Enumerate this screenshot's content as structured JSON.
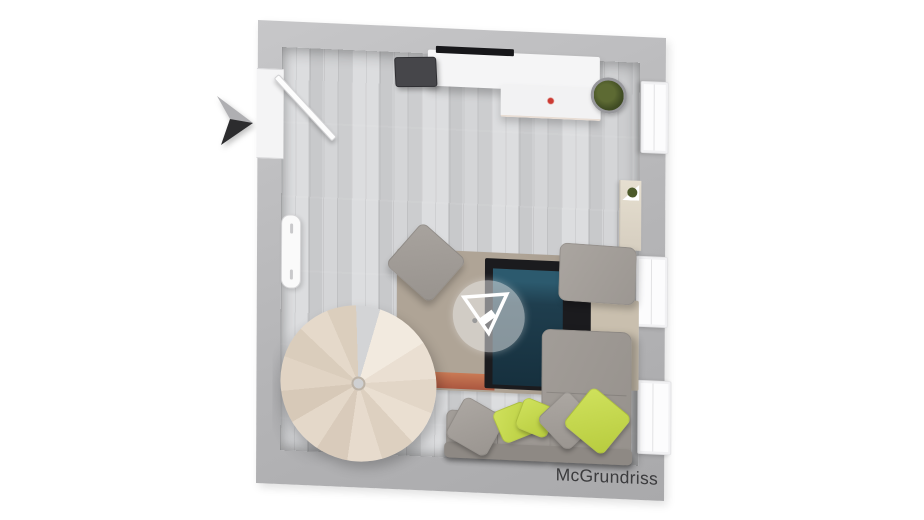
{
  "watermark": {
    "brand": "McGrundriss",
    "logo_icon": "inverted-triangle-logo-icon"
  },
  "scene": {
    "type": "3d-top-down-floor-plan-render",
    "room": "living-room",
    "objects": [
      "entrance-arrow",
      "open-door",
      "radiator",
      "window",
      "window",
      "window",
      "tv-sideboard",
      "tv-screen",
      "white-table",
      "red-flower",
      "potted-plant",
      "wall-shelf-with-plant",
      "rug-taupe",
      "rug-beige",
      "rug-black",
      "rug-navy",
      "rug-orange-stripe",
      "ottoman",
      "square-pouf",
      "sectional-sofa",
      "cushion-gray",
      "cushion-lime",
      "cushion-lime",
      "cushion-gray",
      "cushion-lime",
      "spiral-staircase",
      "wood-plank-floor",
      "watermark-badge"
    ]
  },
  "colors": {
    "bg": "#ffffff",
    "wall": "#b5b5b7",
    "wall_light": "#c7c7c9",
    "wall_dark": "#a9a9ab",
    "floor": "#d4d5d7",
    "floor_dark": "#c8c9cb",
    "floor_light": "#dcdddf",
    "sofa": "#9d9893",
    "sofa_dark": "#8e8984",
    "pillow_lime": "#c6da50",
    "pillow_gray": "#a5a09b",
    "rug_taupe": "#aba092",
    "rug_beige": "#c9bfae",
    "rug_black": "#1b1b1e",
    "rug_navy": "#1f3e4e",
    "rug_teal": "#2c5a6e",
    "rug_orange": "#bd6347",
    "stairs_light": "#f2eadf",
    "stairs_dark": "#d7c9b8",
    "arrow_light": "#afafb2",
    "arrow_dark": "#2c2c2e",
    "plant": "#45521f",
    "accent_red": "#cc3a33",
    "counter": "#f5f5f6",
    "tv": "#46464a",
    "ink": "#3b3b3d"
  }
}
